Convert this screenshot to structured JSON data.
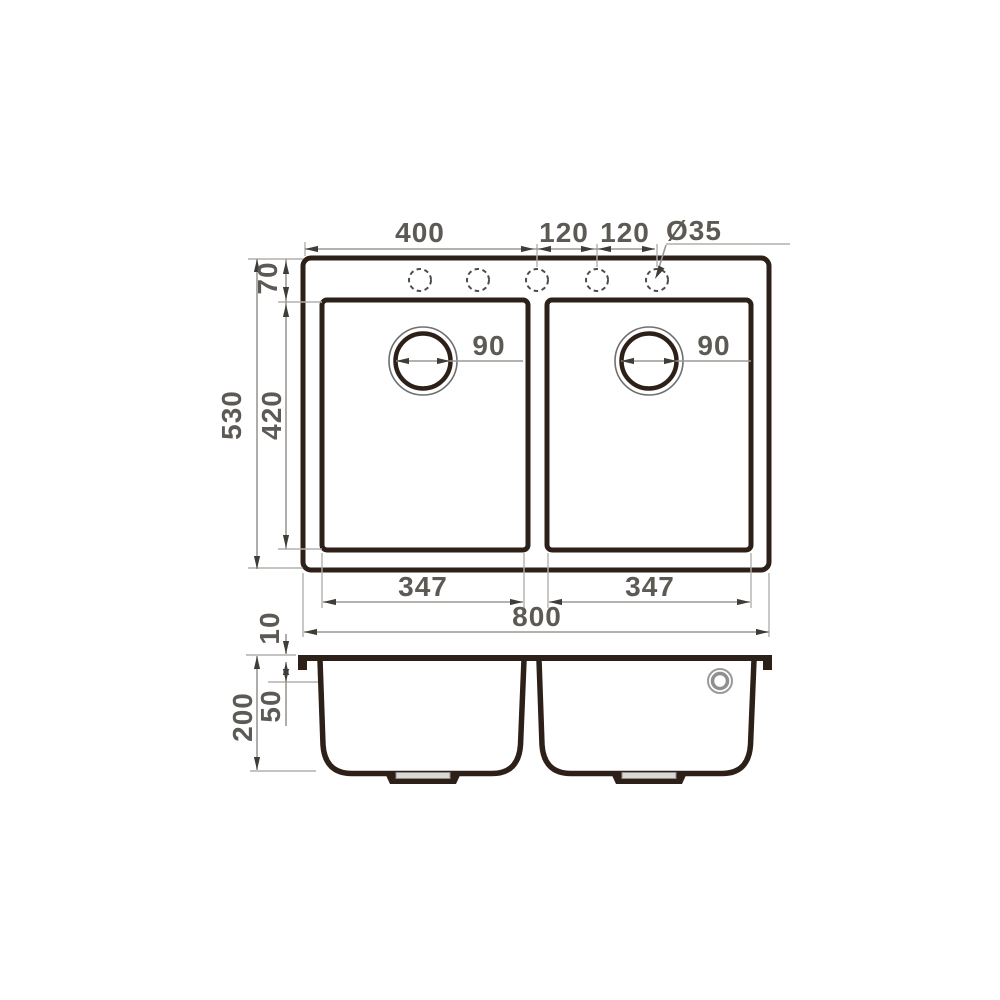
{
  "drawing": {
    "type": "technical-dimension-drawing",
    "views": [
      "top-view",
      "side-section-view"
    ],
    "faucet_hole_count": 5,
    "top_view": {
      "dim_400": "400",
      "dim_120_left": "120",
      "dim_120_right": "120",
      "hole_diameter": "Ø35",
      "dim_70": "70",
      "dim_420": "420",
      "dim_530": "530",
      "drain_left": "90",
      "drain_right": "90",
      "dim_347_left": "347",
      "dim_347_right": "347",
      "dim_800": "800"
    },
    "side_view": {
      "dim_10": "10",
      "dim_50": "50",
      "dim_200": "200"
    },
    "colors": {
      "outline": "#2c2018",
      "dimension_text": "#5d5a55",
      "dimension_line": "#9b9894",
      "arrow": "#403c38",
      "background": "#ffffff"
    }
  }
}
